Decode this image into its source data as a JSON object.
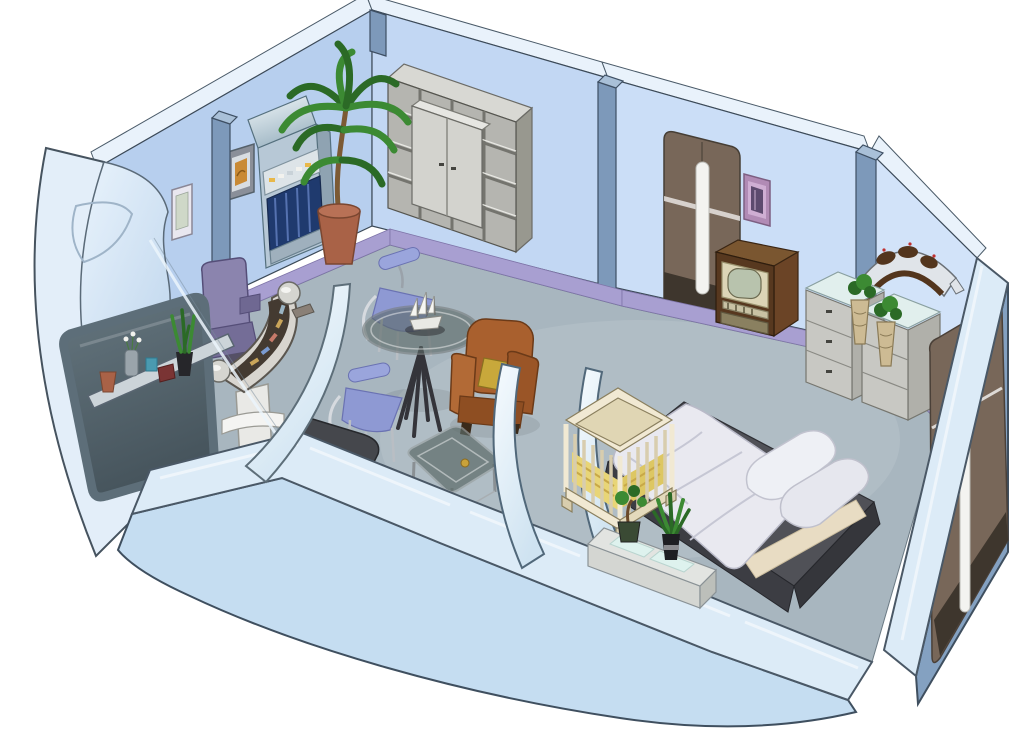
{
  "scene": {
    "type": "isometric-cutaway-room-illustration",
    "title": "Starship crew quarters - isometric cutaway illustration",
    "background": "#ffffff",
    "labels": {
      "room": "crew quarters cutaway",
      "left_wall": "back wall (left segment)",
      "mid_wall": "back wall (middle segment)",
      "right_wall_seg": "back wall (right segment)",
      "corner_wall": "back wall (corner segment)",
      "roofline": "roof edge band",
      "baseboard": "lavender baseboard",
      "floor": "carpeted floor",
      "pillars": "wall support pillars",
      "picture_small": "small framed picture",
      "picture_orange": "orange framed artwork",
      "replicator": "replicator terminal",
      "palm_plant": "potted palm plant",
      "shelving_unit": "cube shelving unit with cabinet",
      "desk_chair": "purple desk chair",
      "desk_console": "curved desk console",
      "hull_window": "curved hull section with window",
      "window_sill": "window sill with plants and books",
      "glass_partition": "glass partition pane",
      "dining_table": "round glass dining table",
      "ship_model": "sailing ship model",
      "dining_chair_far": "dining chair (far)",
      "dining_chair_near": "dining chair (near)",
      "armchair": "brown armchair with yellow cushion",
      "coffee_table": "glass coffee table",
      "sofa_dark": "dark sofa (cut by section)",
      "sofa_pink": "pink couch (cut by section)",
      "arch_partitions": "curved arch partitions",
      "crib": "wooden baby crib",
      "bed": "double bed with duvet and pillows",
      "end_table": "low end table with lit glass panels",
      "bonsai": "bonsai plant",
      "aloe": "aloe plant",
      "door_back": "sliding door (back wall)",
      "art_purple": "purple framed artwork",
      "tv": "retro television cabinet",
      "batleth": "bat'leth wall weapon",
      "dressers": "chests of drawers with glass tops",
      "topiary": "topiary plants in carved vases",
      "front_wall": "front cutaway wall",
      "right_wall_ext": "right wall exterior with door",
      "door_right": "sliding door (right wall)"
    },
    "palette": {
      "wall_left": "#b7cfee",
      "wall_mid": "#c2d7f3",
      "wall_right": "#cbdef7",
      "wall_corner": "#d2e3f9",
      "roof_band": "#e9f2fb",
      "baseboard": "#a89fd1",
      "floor": "#a8b6bf",
      "cut_top": "#dcebf7",
      "cut_face": "#c5ddf1",
      "hull_band": "#e3eef9",
      "pillar": "#7d99ba",
      "door": "#786759",
      "door_dark": "#3e362d",
      "handle": "#f3f3f0",
      "steel_wall": "#84a1c1",
      "window_glass": "#5d6e79",
      "shelf_front": "#b5b5b0",
      "shelf_top": "#d8d8d3",
      "shelf_side": "#98988f",
      "cabinet": "#d3d3ce",
      "replicator": "#b7c8d6",
      "replicator_bay": "#1f3a6e",
      "plant_green": "#3c8a33",
      "plant_dark": "#2b6a26",
      "pot_terracotta": "#a96247",
      "chair_purple": "#8b84ae",
      "chair_purple_dark": "#746d97",
      "desk_body": "#d8d5cf",
      "desk_top": "#443a31",
      "dining_chair": "#9aa5dc",
      "dining_chair_dark": "#8e99d3",
      "armchair": "#a9602e",
      "armchair_dark": "#8e4e22",
      "cushion": "#c8a83b",
      "couch_dark": "#45474c",
      "bench_pink": "#eddad3",
      "crib": "#f1e9d3",
      "bedding_yellow": "#e8d577",
      "platform": "#505157",
      "platform_dark": "#3c3d43",
      "duvet": "#e9e9f0",
      "pillow": "#eef0f5",
      "sheet": "#e8dcc3",
      "table_white": "#e2e4e1",
      "glow": "#def2ee",
      "dresser": "#c8c8c3",
      "dresser_side": "#b0b0aa",
      "dresser_top": "#e1efed",
      "vase": "#cdbb94",
      "tv_wood": "#57381f",
      "tv_side": "#6b4426",
      "tv_face": "#dcd5b7",
      "tv_screen": "#b8c3ad",
      "tv_grille": "#8a8060",
      "batleth_blade": "#e0e4e9",
      "batleth_grip": "#53351d",
      "art_orange": "#c98a35",
      "purple_frame": "#b18bb5",
      "purple_art": "#5d4a6e",
      "frame_white": "#e9e7ef",
      "glass_table": "#5c6a68"
    }
  }
}
